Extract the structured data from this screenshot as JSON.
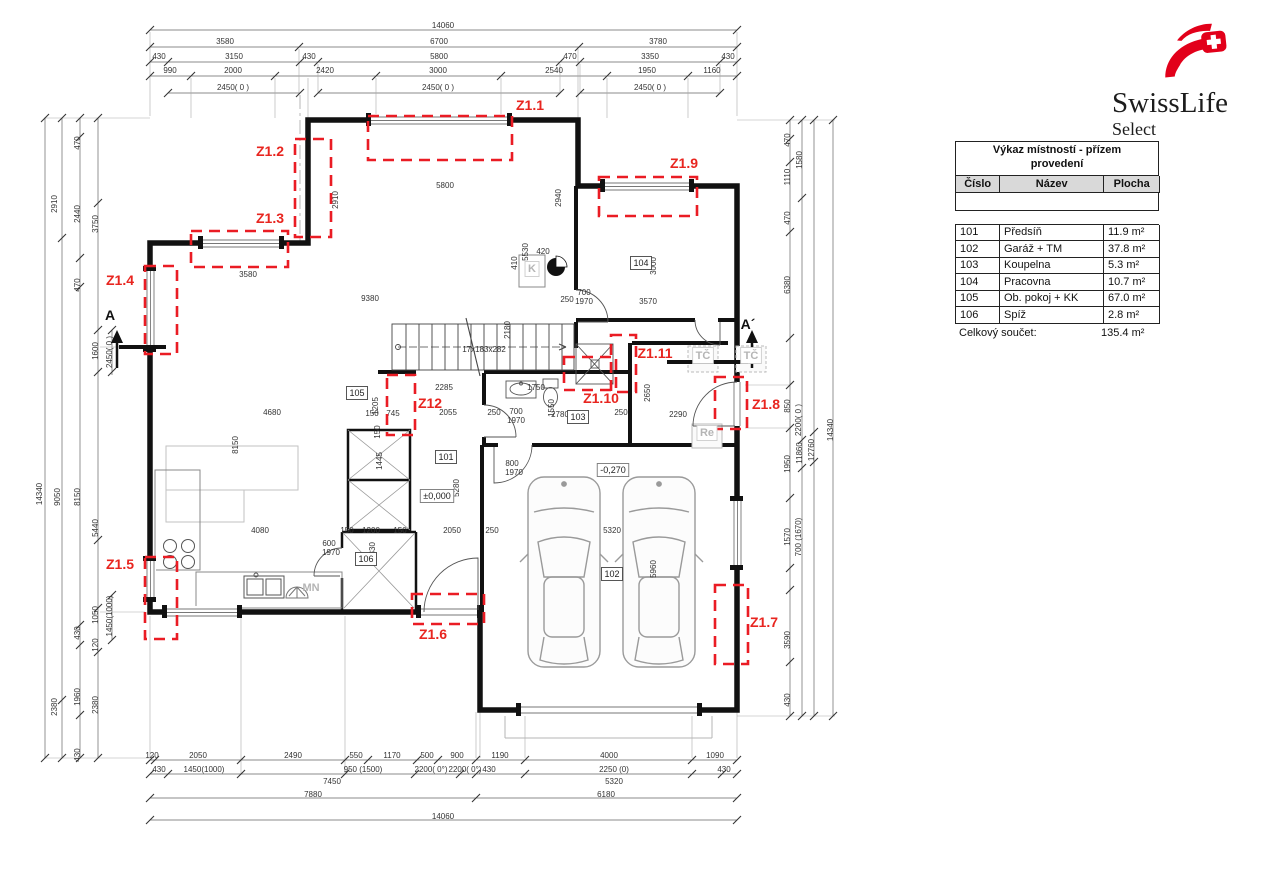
{
  "logo": {
    "brand": "SwissLife",
    "sub": "Select"
  },
  "room_table": {
    "title_line1": "Výkaz místností - přízem",
    "title_line2": "provedení",
    "columns": [
      "Číslo",
      "Název",
      "Plocha"
    ],
    "rows": [
      [
        "101",
        "Předsíň",
        "11.9 m²"
      ],
      [
        "102",
        "Garáž + TM",
        "37.8 m²"
      ],
      [
        "103",
        "Koupelna",
        "5.3 m²"
      ],
      [
        "104",
        "Pracovna",
        "10.7 m²"
      ],
      [
        "105",
        "Ob. pokoj + KK",
        "67.0 m²"
      ],
      [
        "106",
        "Spíž",
        "2.8 m²"
      ]
    ],
    "total_label": "Celkový součet:",
    "total_value": "135.4 m²"
  },
  "plan": {
    "zones": [
      {
        "label": "Z1.1",
        "rect": [
          368,
          116,
          144,
          44
        ],
        "lx": 530,
        "ly": 110
      },
      {
        "label": "Z1.2",
        "rect": [
          295,
          139,
          36,
          98
        ],
        "lx": 270,
        "ly": 156
      },
      {
        "label": "Z1.3",
        "rect": [
          191,
          231,
          97,
          36
        ],
        "lx": 270,
        "ly": 223
      },
      {
        "label": "Z1.4",
        "rect": [
          145,
          266,
          32,
          88
        ],
        "lx": 120,
        "ly": 285
      },
      {
        "label": "Z1.5",
        "rect": [
          145,
          557,
          32,
          82
        ],
        "lx": 120,
        "ly": 569
      },
      {
        "label": "Z1.6",
        "rect": [
          412,
          594,
          72,
          30
        ],
        "lx": 433,
        "ly": 639
      },
      {
        "label": "Z1.7",
        "rect": [
          715,
          585,
          33,
          79
        ],
        "lx": 764,
        "ly": 627
      },
      {
        "label": "Z1.8",
        "rect": [
          715,
          377,
          32,
          52
        ],
        "lx": 766,
        "ly": 409
      },
      {
        "label": "Z1.9",
        "rect": [
          599,
          177,
          98,
          39
        ],
        "lx": 684,
        "ly": 168
      },
      {
        "label": "Z1.10",
        "rect": [
          564,
          357,
          52,
          33
        ],
        "lx": 601,
        "ly": 403
      },
      {
        "label": "Z1.11",
        "rect": [
          611,
          335,
          25,
          57
        ],
        "lx": 655,
        "ly": 358
      },
      {
        "label": "Z12",
        "rect": [
          387,
          375,
          28,
          60
        ],
        "lx": 430,
        "ly": 408
      }
    ],
    "section_markers": [
      {
        "label": "A",
        "x": 110,
        "y": 320
      },
      {
        "label": "A´",
        "x": 748,
        "y": 329
      }
    ],
    "room_labels": [
      {
        "text": "101",
        "x": 446,
        "y": 460
      },
      {
        "text": "102",
        "x": 612,
        "y": 577
      },
      {
        "text": "103",
        "x": 578,
        "y": 420
      },
      {
        "text": "104",
        "x": 641,
        "y": 266
      },
      {
        "text": "105",
        "x": 357,
        "y": 396
      },
      {
        "text": "106",
        "x": 366,
        "y": 562
      }
    ],
    "level_labels": [
      {
        "text": "±0,000",
        "x": 437,
        "y": 499
      },
      {
        "text": "-0,270",
        "x": 613,
        "y": 473
      }
    ],
    "equipment_boxed": [
      {
        "text": "TČ",
        "x": 703,
        "y": 359
      },
      {
        "text": "TČ",
        "x": 751,
        "y": 359
      },
      {
        "text": "Re",
        "x": 707,
        "y": 436
      },
      {
        "text": "K",
        "x": 532,
        "y": 272
      }
    ],
    "equipment_plain": [
      {
        "text": "MN",
        "x": 311,
        "y": 591
      }
    ],
    "dims": [
      [
        "14060",
        443,
        28
      ],
      [
        "3580",
        225,
        44
      ],
      [
        "6700",
        439,
        44
      ],
      [
        "3780",
        658,
        44
      ],
      [
        "430",
        159,
        59
      ],
      [
        "3150",
        234,
        59
      ],
      [
        "430",
        309,
        59
      ],
      [
        "5800",
        439,
        59
      ],
      [
        "470",
        570,
        59
      ],
      [
        "3350",
        650,
        59
      ],
      [
        "430",
        728,
        59
      ],
      [
        "990",
        170,
        73
      ],
      [
        "2000",
        233,
        73
      ],
      [
        "2420",
        325,
        73
      ],
      [
        "3000",
        438,
        73
      ],
      [
        "2540",
        554,
        73
      ],
      [
        "1950",
        647,
        73
      ],
      [
        "1160",
        712,
        73
      ],
      [
        "2450( 0 )",
        233,
        90
      ],
      [
        "2450( 0 )",
        438,
        90
      ],
      [
        "2450( 0 )",
        650,
        90
      ],
      [
        "120",
        152,
        758
      ],
      [
        "2050",
        198,
        758
      ],
      [
        "2490",
        293,
        758
      ],
      [
        "550",
        356,
        758
      ],
      [
        "1170",
        392,
        758
      ],
      [
        "500",
        427,
        758
      ],
      [
        "900",
        457,
        758
      ],
      [
        "1190",
        500,
        758
      ],
      [
        "4000",
        609,
        758
      ],
      [
        "1090",
        715,
        758
      ],
      [
        "430",
        159,
        772
      ],
      [
        "1450(1000)",
        204,
        772
      ],
      [
        "950 (1500)",
        363,
        772
      ],
      [
        "2200( 0°)",
        431,
        772
      ],
      [
        "2200( 0°)",
        465,
        772
      ],
      [
        "430",
        489,
        772
      ],
      [
        "2250 (0)",
        614,
        772
      ],
      [
        "430",
        724,
        772
      ],
      [
        "7450",
        332,
        784
      ],
      [
        "5320",
        614,
        784
      ],
      [
        "7880",
        313,
        797
      ],
      [
        "6180",
        606,
        797
      ],
      [
        "14060",
        443,
        819
      ],
      [
        "470",
        80,
        143,
        1
      ],
      [
        "2910",
        57,
        204,
        1
      ],
      [
        "2440",
        80,
        214,
        1
      ],
      [
        "3750",
        98,
        224,
        1
      ],
      [
        "470",
        80,
        285,
        1
      ],
      [
        "1600",
        98,
        351,
        1
      ],
      [
        "2450( 0 )",
        112,
        352,
        1
      ],
      [
        "14340",
        42,
        494,
        1
      ],
      [
        "9050",
        60,
        497,
        1
      ],
      [
        "8150",
        80,
        497,
        1
      ],
      [
        "5440",
        98,
        528,
        1
      ],
      [
        "1050",
        98,
        615,
        1
      ],
      [
        "1450(1000)",
        112,
        616,
        1
      ],
      [
        "430",
        80,
        633,
        1
      ],
      [
        "120",
        98,
        645,
        1
      ],
      [
        "2380",
        57,
        707,
        1
      ],
      [
        "1960",
        80,
        697,
        1
      ],
      [
        "2380",
        98,
        705,
        1
      ],
      [
        "430",
        80,
        755,
        1
      ],
      [
        "470",
        790,
        140,
        1
      ],
      [
        "1110",
        790,
        177,
        1
      ],
      [
        "1580",
        802,
        160,
        1
      ],
      [
        "470",
        790,
        218,
        1
      ],
      [
        "6380",
        790,
        285,
        1
      ],
      [
        "850",
        790,
        406,
        1
      ],
      [
        "2200( 0 )",
        801,
        420,
        1
      ],
      [
        "1950",
        790,
        464,
        1
      ],
      [
        "11860",
        802,
        453,
        1
      ],
      [
        "12760",
        814,
        450,
        1
      ],
      [
        "14340",
        833,
        430,
        1
      ],
      [
        "1570",
        790,
        537,
        1
      ],
      [
        "700 (1670)",
        801,
        537,
        1
      ],
      [
        "3590",
        790,
        640,
        1
      ],
      [
        "430",
        790,
        700,
        1
      ],
      [
        "5800",
        445,
        188
      ],
      [
        "2910",
        338,
        200,
        1
      ],
      [
        "2940",
        561,
        198,
        1
      ],
      [
        "5530",
        528,
        252,
        1
      ],
      [
        "3580",
        248,
        277
      ],
      [
        "9380",
        370,
        301
      ],
      [
        "3000",
        656,
        266,
        1
      ],
      [
        "3570",
        648,
        304
      ],
      [
        "420",
        543,
        254
      ],
      [
        "410",
        517,
        263,
        1
      ],
      [
        "250",
        567,
        302
      ],
      [
        "700",
        584,
        295
      ],
      [
        "1970",
        584,
        304
      ],
      [
        "2180",
        510,
        330,
        1
      ],
      [
        "17x183x282",
        484,
        352
      ],
      [
        "2285",
        444,
        390
      ],
      [
        "1750",
        536,
        390
      ],
      [
        "1550",
        554,
        408,
        1
      ],
      [
        "2055",
        448,
        415
      ],
      [
        "250",
        494,
        415
      ],
      [
        "700",
        516,
        414
      ],
      [
        "1970",
        516,
        423
      ],
      [
        "2780",
        560,
        417
      ],
      [
        "250",
        621,
        415
      ],
      [
        "2290",
        678,
        417
      ],
      [
        "2650",
        650,
        393,
        1
      ],
      [
        "1205",
        378,
        406,
        1
      ],
      [
        "745",
        393,
        416
      ],
      [
        "150",
        372,
        416
      ],
      [
        "4680",
        272,
        415
      ],
      [
        "8150",
        238,
        445,
        1
      ],
      [
        "1445",
        382,
        461,
        1
      ],
      [
        "150",
        380,
        432,
        1
      ],
      [
        "800",
        512,
        466
      ],
      [
        "1970",
        514,
        475
      ],
      [
        "5280",
        459,
        488,
        1
      ],
      [
        "600",
        329,
        546
      ],
      [
        "1970",
        331,
        555
      ],
      [
        "4080",
        260,
        533
      ],
      [
        "150",
        347,
        533
      ],
      [
        "1200",
        371,
        533
      ],
      [
        "150",
        400,
        533
      ],
      [
        "2330",
        375,
        551,
        1
      ],
      [
        "2050",
        452,
        533
      ],
      [
        "250",
        492,
        533
      ],
      [
        "5320",
        612,
        533
      ],
      [
        "5960",
        656,
        569,
        1
      ]
    ]
  }
}
